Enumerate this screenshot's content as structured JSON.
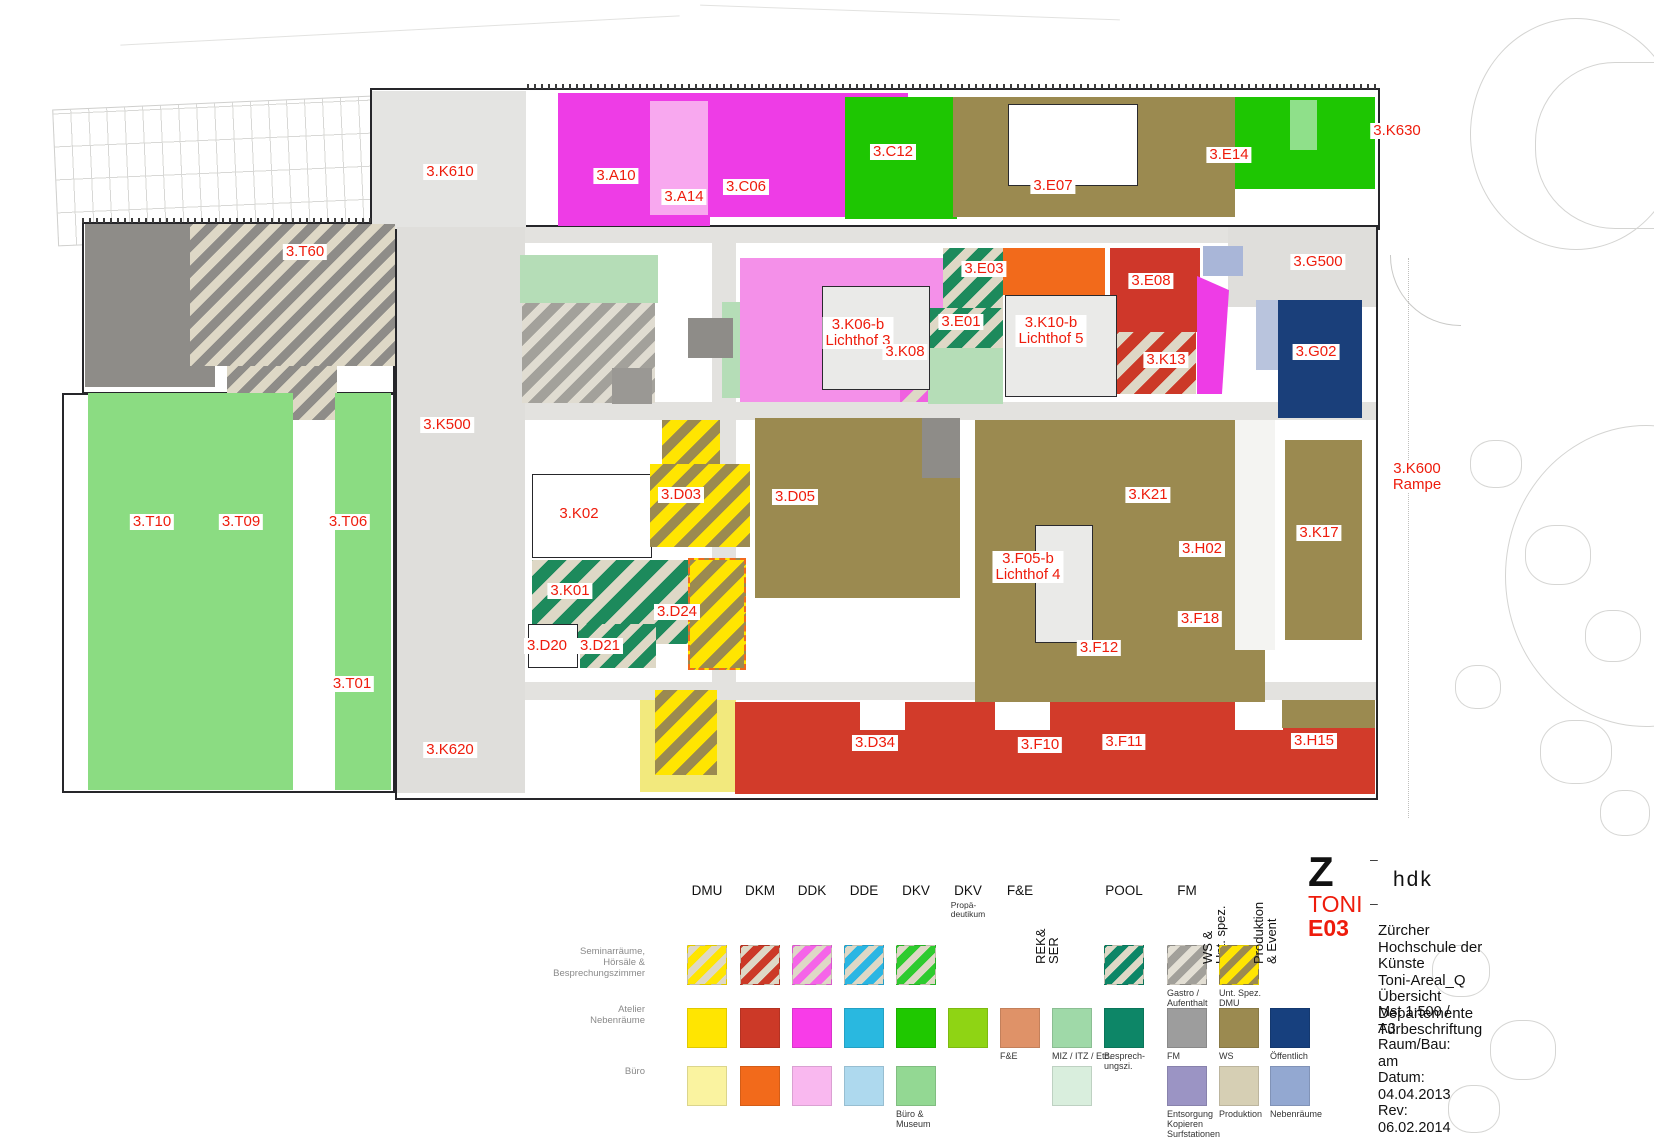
{
  "accent_red": "#ee1c0c",
  "plan": {
    "labels": [
      {
        "text": "3.K610",
        "x": 450,
        "y": 172
      },
      {
        "text": "3.A10",
        "x": 616,
        "y": 176
      },
      {
        "text": "3.A14",
        "x": 684,
        "y": 197
      },
      {
        "text": "3.C06",
        "x": 746,
        "y": 187
      },
      {
        "text": "3.C12",
        "x": 893,
        "y": 152
      },
      {
        "text": "3.E07",
        "x": 1053,
        "y": 186
      },
      {
        "text": "3.E14",
        "x": 1229,
        "y": 155
      },
      {
        "text": "3.K630",
        "x": 1397,
        "y": 131
      },
      {
        "text": "3.T60",
        "x": 305,
        "y": 252
      },
      {
        "text": "3.G500",
        "x": 1318,
        "y": 262
      },
      {
        "text": "3.E03",
        "x": 984,
        "y": 269
      },
      {
        "text": "3.E08",
        "x": 1151,
        "y": 281
      },
      {
        "text": "3.K06-b\nLichthof 3",
        "x": 858,
        "y": 333
      },
      {
        "text": "3.E01",
        "x": 961,
        "y": 322
      },
      {
        "text": "3.K10-b\nLichthof 5",
        "x": 1051,
        "y": 331
      },
      {
        "text": "3.K13",
        "x": 1166,
        "y": 360
      },
      {
        "text": "3.G02",
        "x": 1316,
        "y": 352
      },
      {
        "text": "3.K08",
        "x": 905,
        "y": 352
      },
      {
        "text": "3.K500",
        "x": 447,
        "y": 425
      },
      {
        "text": "3.K600\nRampe",
        "x": 1417,
        "y": 477
      },
      {
        "text": "3.D03",
        "x": 681,
        "y": 495
      },
      {
        "text": "3.K02",
        "x": 579,
        "y": 514
      },
      {
        "text": "3.D05",
        "x": 795,
        "y": 497
      },
      {
        "text": "3.K21",
        "x": 1148,
        "y": 495
      },
      {
        "text": "3.H02",
        "x": 1202,
        "y": 549
      },
      {
        "text": "3.K17",
        "x": 1319,
        "y": 533
      },
      {
        "text": "3.T10",
        "x": 152,
        "y": 522
      },
      {
        "text": "3.T09",
        "x": 241,
        "y": 522
      },
      {
        "text": "3.T06",
        "x": 348,
        "y": 522
      },
      {
        "text": "3.K01",
        "x": 570,
        "y": 591
      },
      {
        "text": "3.F05-b\nLichthof 4",
        "x": 1028,
        "y": 567
      },
      {
        "text": "3.D24",
        "x": 677,
        "y": 612
      },
      {
        "text": "3.F18",
        "x": 1200,
        "y": 619
      },
      {
        "text": "3.D20",
        "x": 547,
        "y": 646
      },
      {
        "text": "3.D21",
        "x": 600,
        "y": 646
      },
      {
        "text": "3.F12",
        "x": 1099,
        "y": 648
      },
      {
        "text": "3.T01",
        "x": 352,
        "y": 684
      },
      {
        "text": "3.K620",
        "x": 450,
        "y": 750
      },
      {
        "text": "3.D34",
        "x": 875,
        "y": 743
      },
      {
        "text": "3.F10",
        "x": 1040,
        "y": 745
      },
      {
        "text": "3.F11",
        "x": 1124,
        "y": 742
      },
      {
        "text": "3.H15",
        "x": 1314,
        "y": 741
      }
    ],
    "zones": [
      {
        "name": "k610-hall",
        "x": 372,
        "y": 91,
        "w": 154,
        "h": 138,
        "fill": "#e4e4e2"
      },
      {
        "name": "corridor-west",
        "x": 397,
        "y": 227,
        "w": 128,
        "h": 566,
        "fill": "#dfdedb"
      },
      {
        "name": "corridor-top",
        "x": 525,
        "y": 227,
        "w": 705,
        "h": 16,
        "fill": "#e3e2df"
      },
      {
        "name": "corridor-mid",
        "x": 525,
        "y": 402,
        "w": 851,
        "h": 18,
        "fill": "#e3e2df"
      },
      {
        "name": "corridor-low",
        "x": 525,
        "y": 682,
        "w": 851,
        "h": 18,
        "fill": "#e3e2df"
      },
      {
        "name": "corridor-center-vert",
        "x": 712,
        "y": 243,
        "w": 24,
        "h": 440,
        "fill": "#e3e2df"
      },
      {
        "name": "g500-plaza",
        "x": 1228,
        "y": 227,
        "w": 148,
        "h": 80,
        "fill": "#dfdedb"
      },
      {
        "name": "a10",
        "x": 558,
        "y": 93,
        "w": 152,
        "h": 133,
        "fill": "#ee3ce6"
      },
      {
        "name": "a14",
        "x": 650,
        "y": 101,
        "w": 58,
        "h": 114,
        "fill": "#f8a8ef"
      },
      {
        "name": "c06",
        "x": 708,
        "y": 93,
        "w": 200,
        "h": 124,
        "fill": "#ee3ce6"
      },
      {
        "name": "c12",
        "x": 845,
        "y": 97,
        "w": 112,
        "h": 122,
        "fill": "#1ec602"
      },
      {
        "name": "e07",
        "x": 953,
        "y": 97,
        "w": 235,
        "h": 120,
        "fill": "#9b8a50"
      },
      {
        "name": "e14-olive",
        "x": 1188,
        "y": 97,
        "w": 47,
        "h": 120,
        "fill": "#9b8a50"
      },
      {
        "name": "e14",
        "x": 1235,
        "y": 97,
        "w": 140,
        "h": 92,
        "fill": "#1ec602"
      },
      {
        "name": "e14-inner",
        "x": 1290,
        "y": 100,
        "w": 27,
        "h": 50,
        "fill": "#8fe08a"
      },
      {
        "name": "t60-gray",
        "x": 85,
        "y": 224,
        "w": 130,
        "h": 163,
        "fill": "#8e8c88"
      },
      {
        "name": "t60-hatch",
        "x": 190,
        "y": 224,
        "w": 205,
        "h": 142,
        "hatch": {
          "bg": "#ded8c6",
          "stripe": "#8e8c88",
          "w1": 9,
          "w2": 9
        }
      },
      {
        "name": "t60-hatch-2",
        "x": 227,
        "y": 366,
        "w": 110,
        "h": 54,
        "hatch": {
          "bg": "#ded8c6",
          "stripe": "#8e8c88",
          "w1": 9,
          "w2": 9
        }
      },
      {
        "name": "miz-north",
        "x": 520,
        "y": 255,
        "w": 138,
        "h": 48,
        "fill": "#b5ddb7"
      },
      {
        "name": "gastro",
        "x": 522,
        "y": 303,
        "w": 133,
        "h": 100,
        "hatch": {
          "bg": "#e0dcd1",
          "stripe": "#a3a19b",
          "w1": 8,
          "w2": 10
        }
      },
      {
        "name": "miz-east",
        "x": 722,
        "y": 302,
        "w": 28,
        "h": 96,
        "fill": "#b5ddb7"
      },
      {
        "name": "stair-core-1",
        "x": 688,
        "y": 318,
        "w": 45,
        "h": 40,
        "fill": "#8e8c88"
      },
      {
        "name": "stair-core-2",
        "x": 612,
        "y": 368,
        "w": 40,
        "h": 36,
        "fill": "#9a9894"
      },
      {
        "name": "lichthof3-pink",
        "x": 740,
        "y": 258,
        "w": 238,
        "h": 144,
        "fill": "#f490e9"
      },
      {
        "name": "k08",
        "x": 900,
        "y": 345,
        "w": 78,
        "h": 57,
        "hatch": {
          "bg": "#ded8c6",
          "stripe": "#f060e0",
          "w1": 10,
          "w2": 12
        }
      },
      {
        "name": "e03",
        "x": 943,
        "y": 248,
        "w": 60,
        "h": 60,
        "hatch": {
          "bg": "#ded8c6",
          "stripe": "#1d8a5c",
          "w1": 9,
          "w2": 11
        }
      },
      {
        "name": "e01",
        "x": 928,
        "y": 308,
        "w": 75,
        "h": 40,
        "hatch": {
          "bg": "#ded8c6",
          "stripe": "#1d8a5c",
          "w1": 9,
          "w2": 11
        }
      },
      {
        "name": "miz-south",
        "x": 928,
        "y": 348,
        "w": 75,
        "h": 56,
        "fill": "#b5ddb7"
      },
      {
        "name": "orange-room",
        "x": 1003,
        "y": 248,
        "w": 102,
        "h": 47,
        "fill": "#f26a1b"
      },
      {
        "name": "e08",
        "x": 1110,
        "y": 248,
        "w": 90,
        "h": 84,
        "fill": "#cf372a"
      },
      {
        "name": "k13",
        "x": 1110,
        "y": 332,
        "w": 86,
        "h": 62,
        "hatch": {
          "bg": "#ded8c6",
          "stripe": "#cc3927",
          "w1": 10,
          "w2": 12
        }
      },
      {
        "name": "magenta-wedge",
        "x": 1197,
        "y": 276,
        "w": 32,
        "h": 118,
        "fill": "#ee3ce6",
        "clip": "polygon(0 0,100% 12%,78% 100%,0 100%)"
      },
      {
        "name": "periwinkle-room",
        "x": 1203,
        "y": 246,
        "w": 40,
        "h": 30,
        "fill": "#a9b6d8"
      },
      {
        "name": "g02-lobby",
        "x": 1256,
        "y": 300,
        "w": 22,
        "h": 70,
        "fill": "#b9c4dd"
      },
      {
        "name": "g02",
        "x": 1278,
        "y": 300,
        "w": 84,
        "h": 118,
        "fill": "#1a3f7a"
      },
      {
        "name": "t-green-a",
        "x": 88,
        "y": 393,
        "w": 205,
        "h": 397,
        "fill": "#8bdc82"
      },
      {
        "name": "t-green-b",
        "x": 335,
        "y": 393,
        "w": 56,
        "h": 397,
        "fill": "#8bdc82"
      },
      {
        "name": "k02",
        "x": 532,
        "y": 474,
        "w": 120,
        "h": 84,
        "fill": "#ffffff",
        "border": "1.5px solid #26262a"
      },
      {
        "name": "d03-upper",
        "x": 662,
        "y": 420,
        "w": 58,
        "h": 44,
        "hatch": {
          "bg": "#9b8a50",
          "stripe": "#ffe501",
          "w1": 10,
          "w2": 12
        }
      },
      {
        "name": "d03",
        "x": 650,
        "y": 464,
        "w": 100,
        "h": 83,
        "hatch": {
          "bg": "#9b8a50",
          "stripe": "#ffe501",
          "w1": 10,
          "w2": 12
        }
      },
      {
        "name": "k01",
        "x": 532,
        "y": 560,
        "w": 170,
        "h": 84,
        "hatch": {
          "bg": "#ded8c6",
          "stripe": "#1d8a5c",
          "w1": 11,
          "w2": 13
        }
      },
      {
        "name": "d24",
        "x": 688,
        "y": 558,
        "w": 58,
        "h": 112,
        "hatch": {
          "bg": "#9b8a50",
          "stripe": "#ffe501",
          "w1": 10,
          "w2": 12
        },
        "border": "2px dashed #f26a1b"
      },
      {
        "name": "d20",
        "x": 528,
        "y": 624,
        "w": 50,
        "h": 44,
        "fill": "#ffffff",
        "border": "1.5px solid #26262a"
      },
      {
        "name": "d21",
        "x": 580,
        "y": 624,
        "w": 76,
        "h": 44,
        "hatch": {
          "bg": "#ded8c6",
          "stripe": "#1d8a5c",
          "w1": 9,
          "w2": 11
        }
      },
      {
        "name": "d05",
        "x": 755,
        "y": 418,
        "w": 205,
        "h": 180,
        "fill": "#9b8a50"
      },
      {
        "name": "stair-core-3",
        "x": 922,
        "y": 418,
        "w": 38,
        "h": 60,
        "fill": "#8e8c88"
      },
      {
        "name": "f-block",
        "x": 975,
        "y": 420,
        "w": 290,
        "h": 340,
        "fill": "#9b8a50"
      },
      {
        "name": "f-gap",
        "x": 1235,
        "y": 420,
        "w": 40,
        "h": 230,
        "fill": "#f4f4f2"
      },
      {
        "name": "k17-block",
        "x": 1285,
        "y": 440,
        "w": 77,
        "h": 200,
        "fill": "#9b8a50"
      },
      {
        "name": "yellow-zone",
        "x": 640,
        "y": 700,
        "w": 96,
        "h": 92,
        "fill": "#f2e97d"
      },
      {
        "name": "hatch-bottom",
        "x": 655,
        "y": 690,
        "w": 62,
        "h": 85,
        "hatch": {
          "bg": "#9b8a50",
          "stripe": "#ffe501",
          "w1": 10,
          "w2": 12
        }
      },
      {
        "name": "red-band",
        "x": 735,
        "y": 702,
        "w": 640,
        "h": 92,
        "fill": "#d23b2a"
      },
      {
        "name": "red-band-notch-1",
        "x": 860,
        "y": 702,
        "w": 45,
        "h": 28,
        "fill": "#ffffff"
      },
      {
        "name": "red-band-notch-2",
        "x": 995,
        "y": 702,
        "w": 55,
        "h": 28,
        "fill": "#ffffff"
      },
      {
        "name": "red-band-notch-3",
        "x": 1235,
        "y": 702,
        "w": 48,
        "h": 28,
        "fill": "#ffffff"
      },
      {
        "name": "olive-strip-se",
        "x": 1282,
        "y": 700,
        "w": 93,
        "h": 28,
        "fill": "#9b8a50"
      }
    ],
    "courts": [
      {
        "name": "e07-court",
        "x": 1008,
        "y": 104,
        "w": 130,
        "h": 82
      },
      {
        "name": "lichthof3-court",
        "x": 822,
        "y": 286,
        "w": 108,
        "h": 104
      },
      {
        "name": "lichthof5-court",
        "x": 1005,
        "y": 295,
        "w": 112,
        "h": 102
      },
      {
        "name": "lichthof4-court",
        "x": 1035,
        "y": 525,
        "w": 58,
        "h": 118
      }
    ]
  },
  "legend": {
    "row_labels": [
      "Seminarräume,\nHörsäle &\nBesprechungszimmer",
      "Atelier\nNebenräume",
      "Büro"
    ],
    "rows_y": {
      "row1": 945,
      "row2": 1008,
      "row3": 1066
    },
    "swatch": 40,
    "columns": [
      {
        "cx": 707,
        "header": "DMU",
        "row1": {
          "type": "hatch",
          "bg": "#ded8c6",
          "stripe": "#ffe501"
        },
        "row2": {
          "type": "solid",
          "color": "#ffe501"
        },
        "row3": {
          "type": "solid",
          "color": "#faf3a0"
        }
      },
      {
        "cx": 760,
        "header": "DKM",
        "row1": {
          "type": "hatch",
          "bg": "#ded8c6",
          "stripe": "#cc3927"
        },
        "row2": {
          "type": "solid",
          "color": "#cc3927"
        },
        "row3": {
          "type": "solid",
          "color": "#f26a1b"
        }
      },
      {
        "cx": 812,
        "header": "DDK",
        "row1": {
          "type": "hatch",
          "bg": "#ded8c6",
          "stripe": "#f565e8"
        },
        "row2": {
          "type": "solid",
          "color": "#f83ce8"
        },
        "row3": {
          "type": "solid",
          "color": "#f9b8ef"
        }
      },
      {
        "cx": 864,
        "header": "DDE",
        "row1": {
          "type": "hatch",
          "bg": "#ded8c6",
          "stripe": "#2ab6e3"
        },
        "row2": {
          "type": "solid",
          "color": "#29b8e0"
        },
        "row3": {
          "type": "solid",
          "color": "#aed9ee"
        }
      },
      {
        "cx": 916,
        "header": "DKV",
        "row1": {
          "type": "hatch",
          "bg": "#ded8c6",
          "stripe": "#2ecb2e"
        },
        "row2": {
          "type": "solid",
          "color": "#1fc800"
        },
        "row3": {
          "type": "solid",
          "color": "#93d893",
          "caption": "Büro &\nMuseum"
        }
      },
      {
        "cx": 968,
        "header": "DKV",
        "header_sub": "Propä-\ndeutikum",
        "row2": {
          "type": "solid",
          "color": "#8fd414"
        }
      },
      {
        "cx": 1020,
        "header": "F&E",
        "row2": {
          "type": "solid",
          "color": "#df9268",
          "caption": "F&E"
        }
      },
      {
        "cx": 1072,
        "header": "REK&\nSER",
        "rotated": true,
        "row2": {
          "type": "solid",
          "color": "#9fd9a8",
          "caption": "MIZ / ITZ / Etc."
        },
        "row3": {
          "type": "solid",
          "color": "#d9eedd"
        }
      },
      {
        "cx": 1124,
        "header": "POOL",
        "row1": {
          "type": "hatch",
          "bg": "#ded8c6",
          "stripe": "#0d8667"
        },
        "row2": {
          "type": "solid",
          "color": "#0d8667",
          "caption": "Besprech-\nungszi."
        }
      },
      {
        "cx": 1187,
        "header": "FM",
        "row1": {
          "type": "hatch",
          "bg": "#e3dfd4",
          "stripe": "#a2a09a",
          "caption": "Gastro /\nAufenthalt"
        },
        "row2": {
          "type": "solid",
          "color": "#9d9d9d",
          "caption": "FM"
        },
        "row3": {
          "type": "solid",
          "color": "#9b94c4",
          "caption": "Entsorgung\nKopieren\nSurfstationen"
        }
      },
      {
        "cx": 1239,
        "header": "WS &\nUnt. spez.",
        "rotated": true,
        "row1": {
          "type": "hatch",
          "bg": "#9b8a50",
          "stripe": "#ffe501",
          "caption": "Unt. Spez. DMU"
        },
        "row2": {
          "type": "solid",
          "color": "#9b8a50",
          "caption": "WS"
        },
        "row3": {
          "type": "solid",
          "color": "#d6cfb4",
          "caption": "Produktion"
        }
      },
      {
        "cx": 1290,
        "header": "Produktion\n& Event",
        "rotated": true,
        "row2": {
          "type": "solid",
          "color": "#17407e",
          "caption": "Öffentlich"
        },
        "row3": {
          "type": "solid",
          "color": "#93a8d1",
          "caption": "Nebenräume"
        }
      }
    ]
  },
  "title_block": {
    "logo_z": "Z",
    "dash": "–",
    "logo_hdk": "hdk",
    "project": "TONI",
    "sheet": "E03",
    "title_lines": [
      "Zürcher Hochschule der Künste",
      "Toni-Areal_Q",
      "Übersicht Departemente",
      "Türbeschriftung"
    ],
    "meta_lines": [
      "Mst 1:500 / A3",
      "Raum/Bau: am",
      "Datum: 04.04.2013",
      "Rev: 06.02.2014"
    ]
  }
}
